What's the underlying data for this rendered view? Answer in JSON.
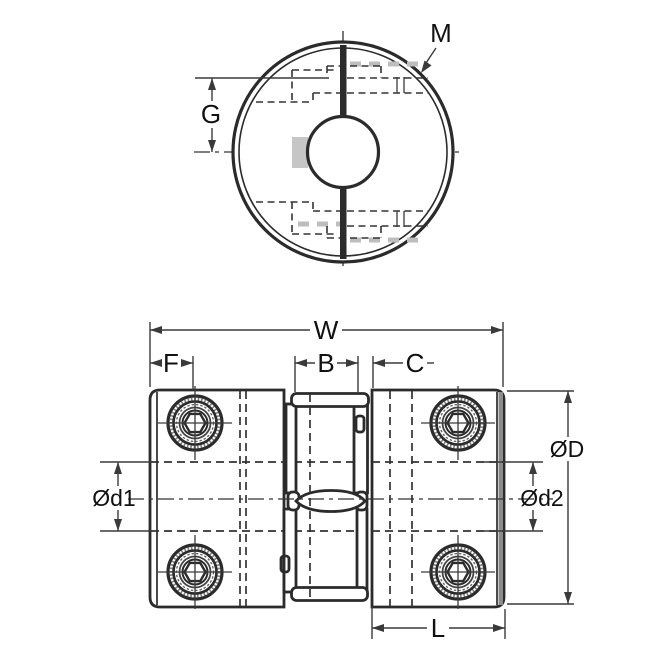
{
  "drawing": {
    "title": "jaw-coupling-technical-drawing",
    "colors": {
      "line": "#2b2b2b",
      "dimension": "#3a3a3a",
      "shading": "#c6c6c6",
      "edge_shade": "#8c8c8c",
      "background": "#ffffff"
    },
    "front_view": {
      "labels": {
        "screw_callout": "M",
        "dim_screw_offset": "G"
      }
    },
    "side_view": {
      "labels": {
        "dim_overall_width": "W",
        "dim_hub_edge": "F",
        "dim_spider": "B",
        "dim_gap": "C",
        "dim_hub_length": "L",
        "dim_outer_diameter": "ØD",
        "dim_bore_left": "Ød1",
        "dim_bore_right": "Ød2"
      }
    }
  }
}
